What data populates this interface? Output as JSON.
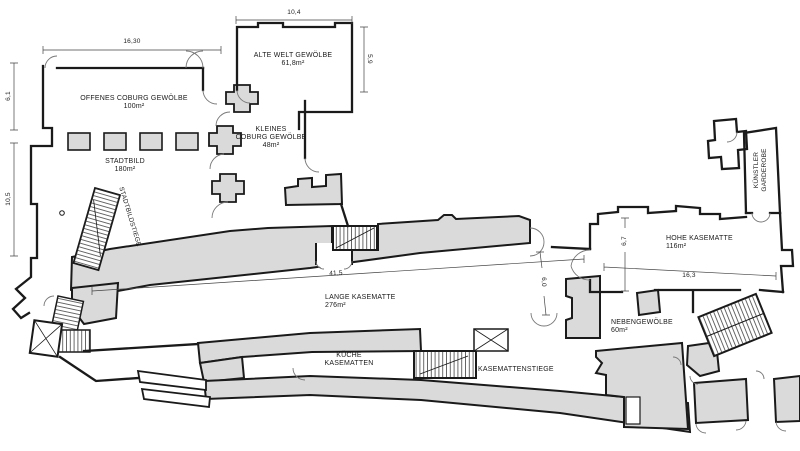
{
  "plan": {
    "title": "Kasematten floor plan",
    "rooms": {
      "alte_welt": {
        "name": "ALTE WELT GEWÖLBE",
        "area": "61,8m²"
      },
      "offenes": {
        "name": "OFFENES COBURG GEWÖLBE",
        "area": "100m²"
      },
      "kleines": {
        "name_line1": "KLEINES",
        "name_line2": "COBURG GEWÖLBE",
        "area": "48m²"
      },
      "stadtbild": {
        "name": "STADTBILD",
        "area": "180m²"
      },
      "lange": {
        "name": "LANGE KASEMATTE",
        "area": "276m²"
      },
      "hohe": {
        "name": "HOHE KASEMATTE",
        "area": "116m²"
      },
      "nebengewoelbe": {
        "name": "NEBENGEWÖLBE",
        "area": "60m²"
      },
      "kueche": {
        "name_line1": "KÜCHE",
        "name_line2": "KASEMATTEN"
      },
      "kuenstler": {
        "name_line1": "KÜNSTLER",
        "name_line2": "GARDEROBE"
      }
    },
    "stairs": {
      "stadtbildstiege": {
        "label": "STADTBILDSTIEGE"
      },
      "kasemattenstiege": {
        "label": "KASEMATTENSTIEGE"
      }
    },
    "dimensions": {
      "offenes_width": "16,30",
      "alte_welt_width": "10,4",
      "alte_welt_height": "5,9",
      "left_upper_height": "6,1",
      "left_lower_height": "10,5",
      "lange_length": "41,5",
      "hohe_height": "6,7",
      "hohe_width": "16,3",
      "corridor_width": "6,0"
    },
    "colors": {
      "wall": "#1a1a1a",
      "room_fill": "#dadada",
      "background": "#ffffff",
      "thin_line": "#666666"
    }
  }
}
